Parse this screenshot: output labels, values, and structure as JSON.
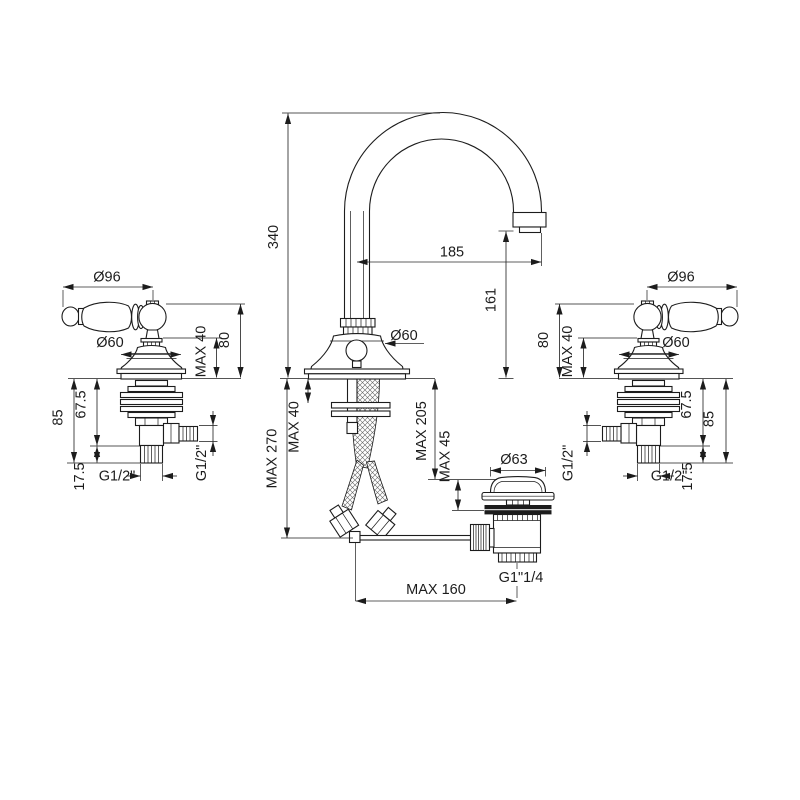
{
  "document": {
    "background": "#ffffff",
    "line_color": "#1c1c1c"
  },
  "spout": {
    "height": "340",
    "reach": "185",
    "outlet_height": "161",
    "base_diameter": "Ø60",
    "max_mounting_thickness": "MAX 40",
    "hose_drop_max": "MAX 270"
  },
  "handles": {
    "left": {
      "lever_diameter": "Ø96",
      "base_diameter": "Ø60",
      "height": "80",
      "max_mounting_thickness": "MAX 40",
      "below_deck_total": "85",
      "below_deck_body": "67.5",
      "inlet_thread_length": "17.5",
      "outlet_thread": "G1/2\"",
      "inlet_thread": "G1/2\""
    },
    "right": {
      "lever_diameter": "Ø96",
      "base_diameter": "Ø60",
      "height": "80",
      "max_mounting_thickness": "MAX 40",
      "below_deck_total": "85",
      "below_deck_body": "67.5",
      "inlet_thread_length": "17.5",
      "outlet_thread": "G1/2\"",
      "inlet_thread": "G1/2\""
    }
  },
  "drain": {
    "rod_drop_max": "MAX 205",
    "max_mounting_thickness": "MAX 45",
    "cap_diameter": "Ø63",
    "outlet_thread": "G1\"1/4",
    "rod_reach_max": "MAX 160"
  }
}
